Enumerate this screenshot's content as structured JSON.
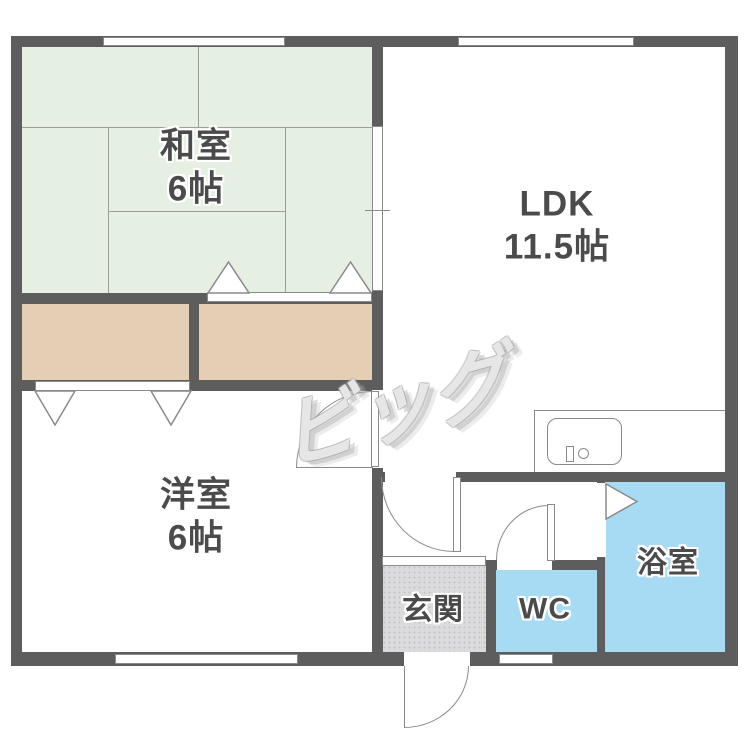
{
  "plan": {
    "watermark": "ビッグ",
    "rooms": {
      "washitsu": {
        "name": "和室",
        "size": "6帖"
      },
      "ldk": {
        "name": "LDK",
        "size": "11.5帖"
      },
      "youshitsu": {
        "name": "洋室",
        "size": "6帖"
      },
      "genkan": {
        "name": "玄関"
      },
      "wc": {
        "name": "WC"
      },
      "bathroom": {
        "name": "浴室"
      }
    },
    "colors": {
      "wall": "#5d5d5d",
      "tatami": "#e5efe2",
      "tatami-line": "#9aa096",
      "closet": "#e4cfb4",
      "water": "#a7daf3",
      "entry": "#dbdbdd",
      "entry-dot": "#c3c3c9",
      "line": "#8a8a8a",
      "label": "#4b4b4b"
    }
  }
}
